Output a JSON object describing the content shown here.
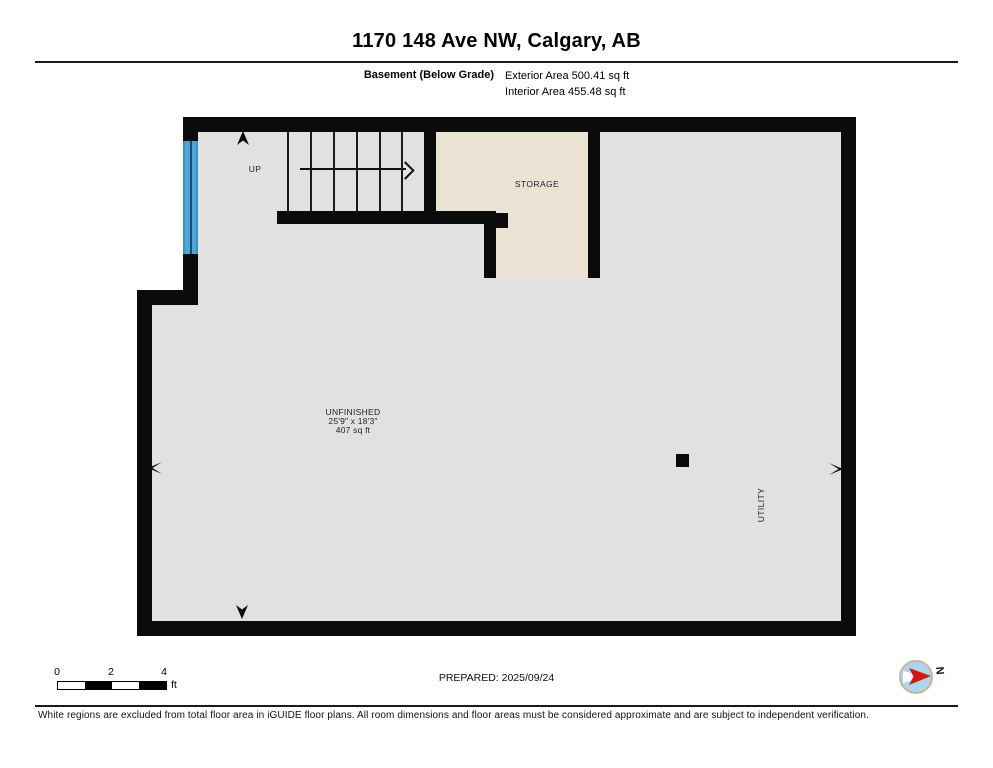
{
  "header": {
    "title": "1170 148 Ave NW, Calgary, AB",
    "floor_label": "Basement (Below Grade)",
    "exterior_area": "Exterior Area 500.41 sq ft",
    "interior_area": "Interior Area 455.48 sq ft"
  },
  "plan": {
    "stairs_label": "UP",
    "rooms": {
      "storage": {
        "label": "STORAGE"
      },
      "unfinished": {
        "label": "UNFINISHED",
        "dimensions": "25'9\" x 18'3\"",
        "area": "407 sq ft"
      },
      "utility": {
        "label": "UTILITY"
      }
    },
    "colors": {
      "wall": "#0b0b0b",
      "floor": "#e1e1e1",
      "storage_floor": "#eae2d3",
      "window": "#4da5d8"
    }
  },
  "footer": {
    "scale": {
      "ticks": [
        "0",
        "2",
        "4"
      ],
      "unit": "ft"
    },
    "prepared": "PREPARED: 2025/09/24",
    "compass_label": "N",
    "compass_colors": {
      "disc": "#abd7ec",
      "needle": "#d6180b",
      "ring": "#c6b69e"
    },
    "disclaimer": "White regions are excluded from total floor area in iGUIDE floor plans. All room dimensions and floor areas must be considered approximate and are subject to independent verification."
  }
}
